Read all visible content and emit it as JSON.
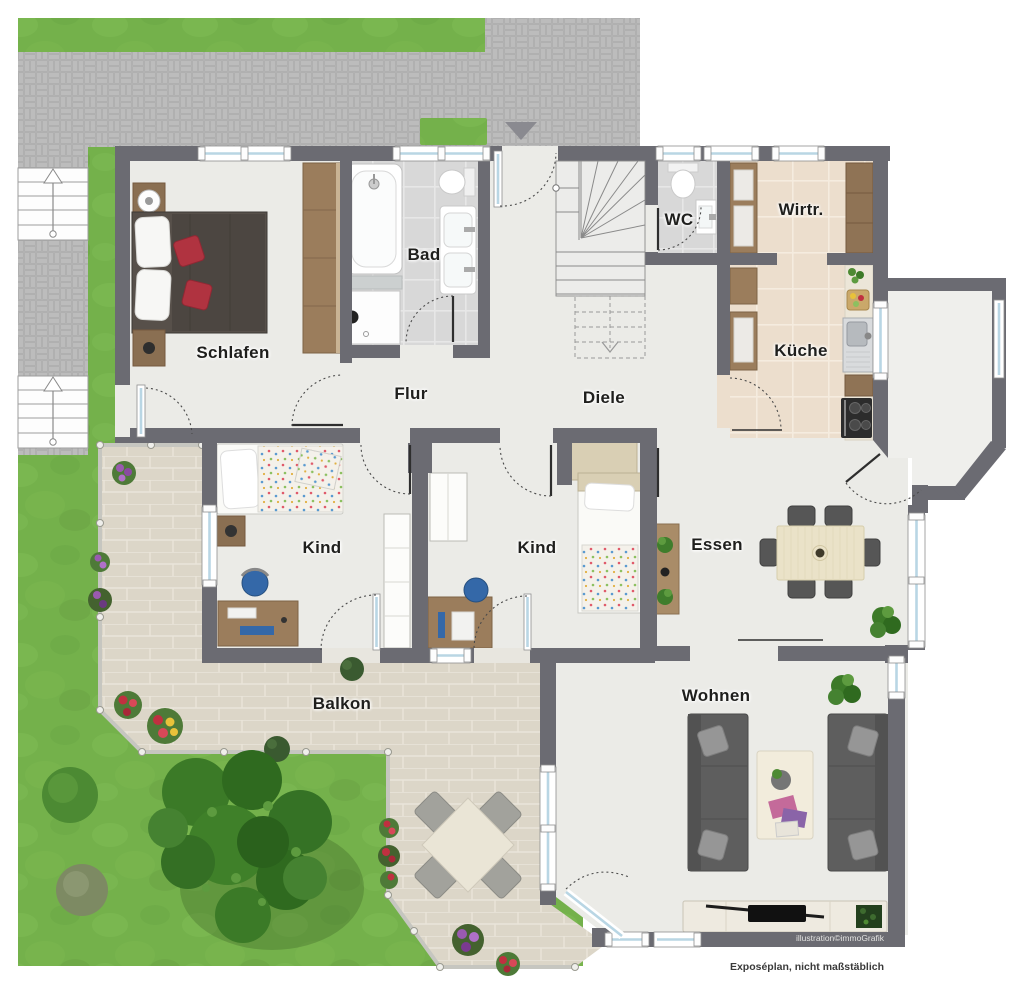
{
  "rooms": [
    {
      "id": "schlafen",
      "label": "Schlafen"
    },
    {
      "id": "bad",
      "label": "Bad"
    },
    {
      "id": "flur",
      "label": "Flur"
    },
    {
      "id": "diele",
      "label": "Diele"
    },
    {
      "id": "wc",
      "label": "WC"
    },
    {
      "id": "wirtschaftsraum",
      "label": "Wirtr."
    },
    {
      "id": "kueche",
      "label": "Küche"
    },
    {
      "id": "kind-1",
      "label": "Kind"
    },
    {
      "id": "kind-2",
      "label": "Kind"
    },
    {
      "id": "essen",
      "label": "Essen"
    },
    {
      "id": "balkon",
      "label": "Balkon"
    },
    {
      "id": "wohnen",
      "label": "Wohnen"
    }
  ],
  "footer": {
    "credit": "illustration©immoGrafik",
    "disclaimer": "Exposéplan, nicht maßstäblich"
  },
  "colors": {
    "wall": "#6b6b72",
    "floor": "#ebebe7",
    "tilegray": "#d8d8d8",
    "tilebeige": "#ecdecd",
    "balcony": "#dcd6c8",
    "paver": "#bcbcbc",
    "grass": "#74b14b",
    "glass": "#b9d6e4",
    "wood": "#9b7d5c",
    "woodlight": "#e9e1ca",
    "sofa": "#5e5e5e",
    "red": "#b03340",
    "blue": "#3468a8",
    "tree": "#3c7a28",
    "label": "#1f1f1d"
  }
}
